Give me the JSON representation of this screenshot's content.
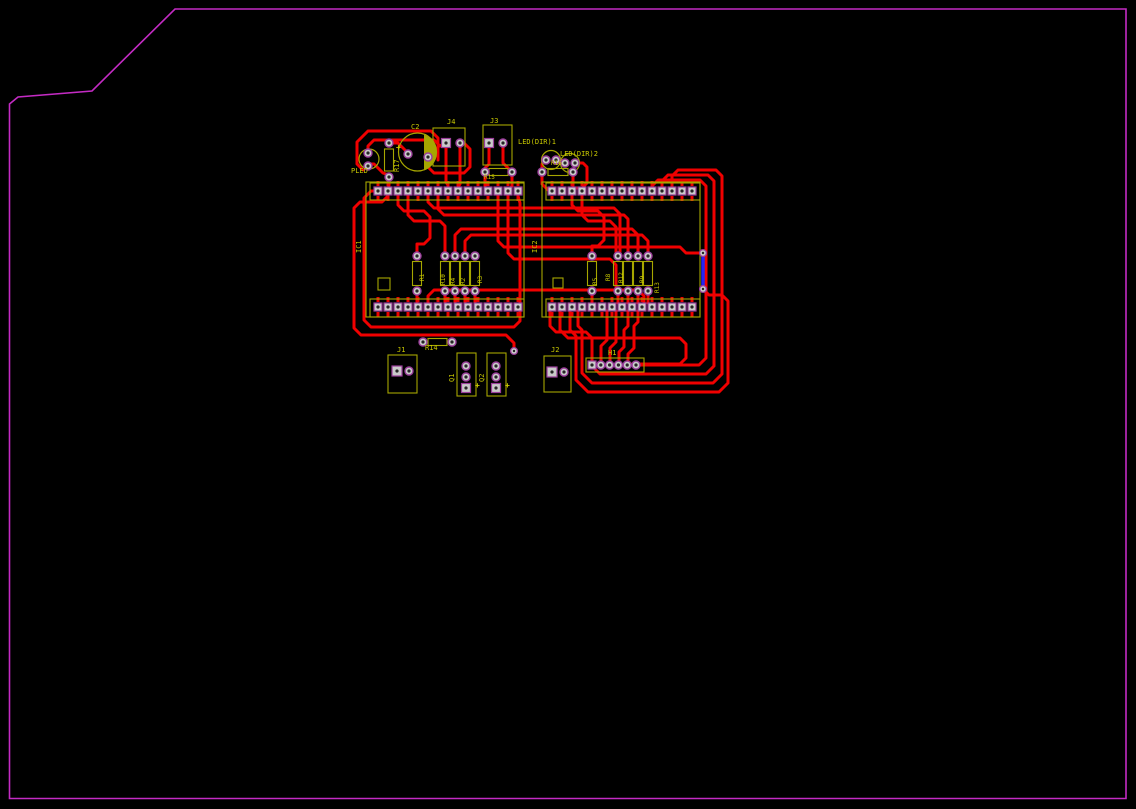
{
  "view": {
    "type": "pcb-layout-canvas",
    "background": "#000000"
  },
  "colors": {
    "board_outline": "#C42BC4",
    "copper_top": "#F00000",
    "copper_bottom": "#2525F5",
    "pad_fill": "#CACACA",
    "pad_ring": "#9B3F9B",
    "drill": "#262626",
    "silkscreen": "#A6A600",
    "label": "#C9C900"
  },
  "components": {
    "pled": {
      "label": "PLED"
    },
    "r17": {
      "label": "R17"
    },
    "c2": {
      "label": "C2",
      "polarity": "+"
    },
    "j4": {
      "label": "J4"
    },
    "j3": {
      "label": "J3"
    },
    "led_dir1": {
      "label": "LED(DIR)1"
    },
    "led_dir2": {
      "label": "LED(DIR)2"
    },
    "r15": {
      "label": "R15"
    },
    "r16": {
      "label": "R16"
    },
    "ic1": {
      "label": "IC1"
    },
    "ic2": {
      "label": "IC2"
    },
    "r1": {
      "label": "R1"
    },
    "r10": {
      "label": "R10"
    },
    "r4": {
      "label": "R4"
    },
    "r2": {
      "label": "R2"
    },
    "r3": {
      "label": "R3"
    },
    "r5": {
      "label": "R5"
    },
    "r8": {
      "label": "R8"
    },
    "r12": {
      "label": "R12"
    },
    "r9": {
      "label": "R9"
    },
    "r13": {
      "label": "R13"
    },
    "r14": {
      "label": "R14"
    },
    "j1": {
      "label": "J1"
    },
    "q1": {
      "label": "Q1",
      "polarity": "+"
    },
    "q2": {
      "label": "Q2",
      "polarity": "+"
    },
    "j2": {
      "label": "J2"
    },
    "h1": {
      "label": "H1"
    }
  },
  "headers": {
    "ic1_top_pins": 15,
    "ic1_bottom_pins": 15,
    "ic2_top_pins": 15,
    "ic2_bottom_pins": 15,
    "h1_pins": 6
  }
}
